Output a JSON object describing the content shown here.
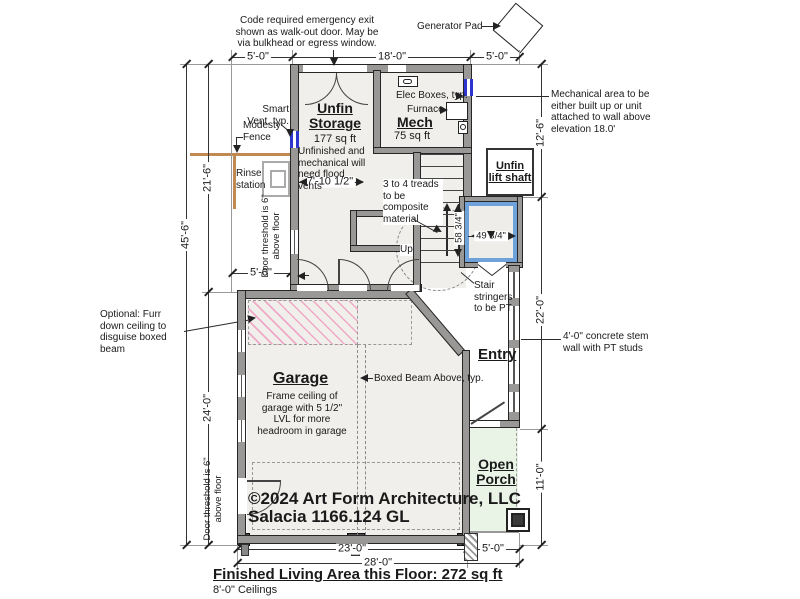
{
  "notes": {
    "emergency_exit": "Code required emergency exit shown as walk-out door. May be via bulkhead or egress window.",
    "generator_pad": "Generator Pad",
    "smart_vent": "Smart Vent, typ.",
    "modesty_fence": "Modesty Fence",
    "rinse_station": "Rinse station",
    "flood_vents": "Unfinished and mechanical will need flood vents",
    "door_threshold": "Door threshold is 6\" above floor",
    "elec_boxes": "Elec Boxes, typ.",
    "furnace": "Furnace",
    "mech_area": "Mechanical area to be either built up or unit attached to wall above elevation 18.0'",
    "treads": "3 to 4 treads to be composite material",
    "up": "Up",
    "stair_stringers": "Stair stringers to be PT",
    "stem_wall": "4'-0\" concrete stem wall with PT studs",
    "furr_down": "Optional: Furr down ceiling to disguise boxed beam",
    "boxed_beam": "Boxed Beam Above, typ."
  },
  "rooms": {
    "storage": {
      "name": "Unfin Storage",
      "area": "177 sq ft"
    },
    "mech": {
      "name": "Mech",
      "area": "75 sq ft"
    },
    "lift": {
      "name": "Unfin lift shaft"
    },
    "entry": {
      "name": "Entry"
    },
    "garage": {
      "name": "Garage",
      "note": "Frame ceiling of garage with 5 1/2\" LVL for more headroom in garage"
    },
    "porch": {
      "name": "Open Porch"
    }
  },
  "dims": {
    "top_left": "5'-0\"",
    "top_mid": "18'-0\"",
    "top_right": "5'-0\"",
    "left_overall": "45'-6\"",
    "left_upper": "21'-6\"",
    "left_lower": "24'-0\"",
    "left_inner": "5'-0\"",
    "storage_width": "7'-10 1/2\"",
    "stair_run": "58 3/4\"",
    "lift_width": "49 3/4\"",
    "right_upper": "12'-6\"",
    "right_mid": "22'-0\"",
    "right_lower": "11'-0\"",
    "bottom_left": "23'-0\"",
    "bottom_right": "5'-0\"",
    "bottom_overall": "28'-0\""
  },
  "footer": {
    "copyright": "©2024 Art Form Architecture, LLC",
    "plan_id": "Salacia 1166.124 GL",
    "living_area": "Finished Living Area this Floor: 272 sq ft",
    "ceilings": "8'-0\" Ceilings"
  },
  "colors": {
    "wall_gray": "#9a9896",
    "hatch_pink": "#efa8c6",
    "porch_green": "#e9f3e6",
    "window_blue": "#2d35cf",
    "lift_blue": "#6ea2d8",
    "fence_tan": "#c08a52"
  }
}
